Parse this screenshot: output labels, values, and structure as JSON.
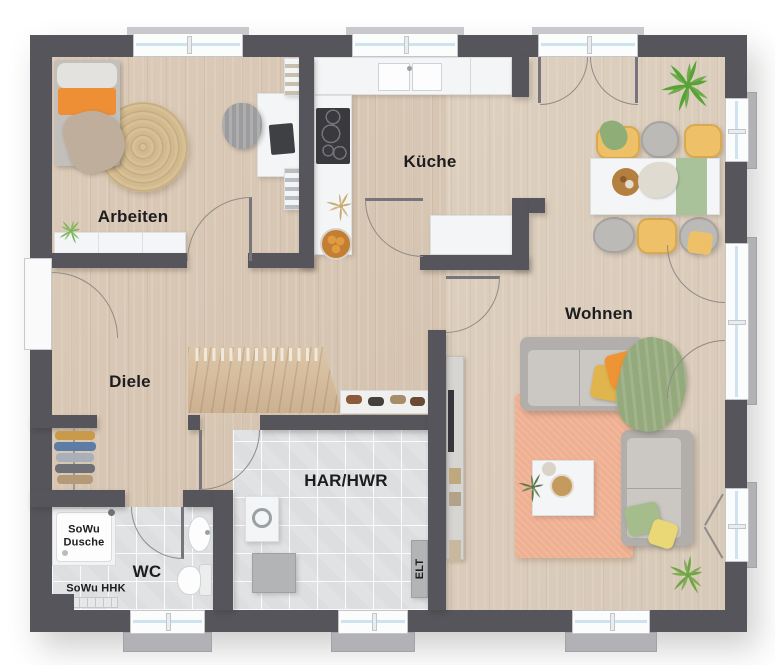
{
  "page": {
    "type": "floor-plan-rendering"
  },
  "labels": {
    "arbeiten": "Arbeiten",
    "kueche": "Küche",
    "wohnen": "Wohnen",
    "diele": "Diele",
    "har_hwr": "HAR/HWR",
    "wc": "WC",
    "dusche": "SoWu Dusche",
    "hhk": "SoWu HHK",
    "elt": "ELT"
  },
  "colors": {
    "wall": "#56555b",
    "wood_floor": "#d9c7b3",
    "tile_floor": "#e1e2e4",
    "stair_wood": "#d6bf9f",
    "window_glass": "#cde3f0",
    "window_frame": "#fbfcfc",
    "sill": "#b2b1b6",
    "rug_peach": "#efb092",
    "rug_jute": "#d5bd94",
    "sofa_gray": "#c2bfbc",
    "accent_orange": "#ee9134",
    "accent_yellow": "#e9c568",
    "accent_green": "#97ad7f",
    "chair_yellow": "#eec169",
    "plant_green": "#66a33e",
    "label_text": "#1d1d1f"
  }
}
